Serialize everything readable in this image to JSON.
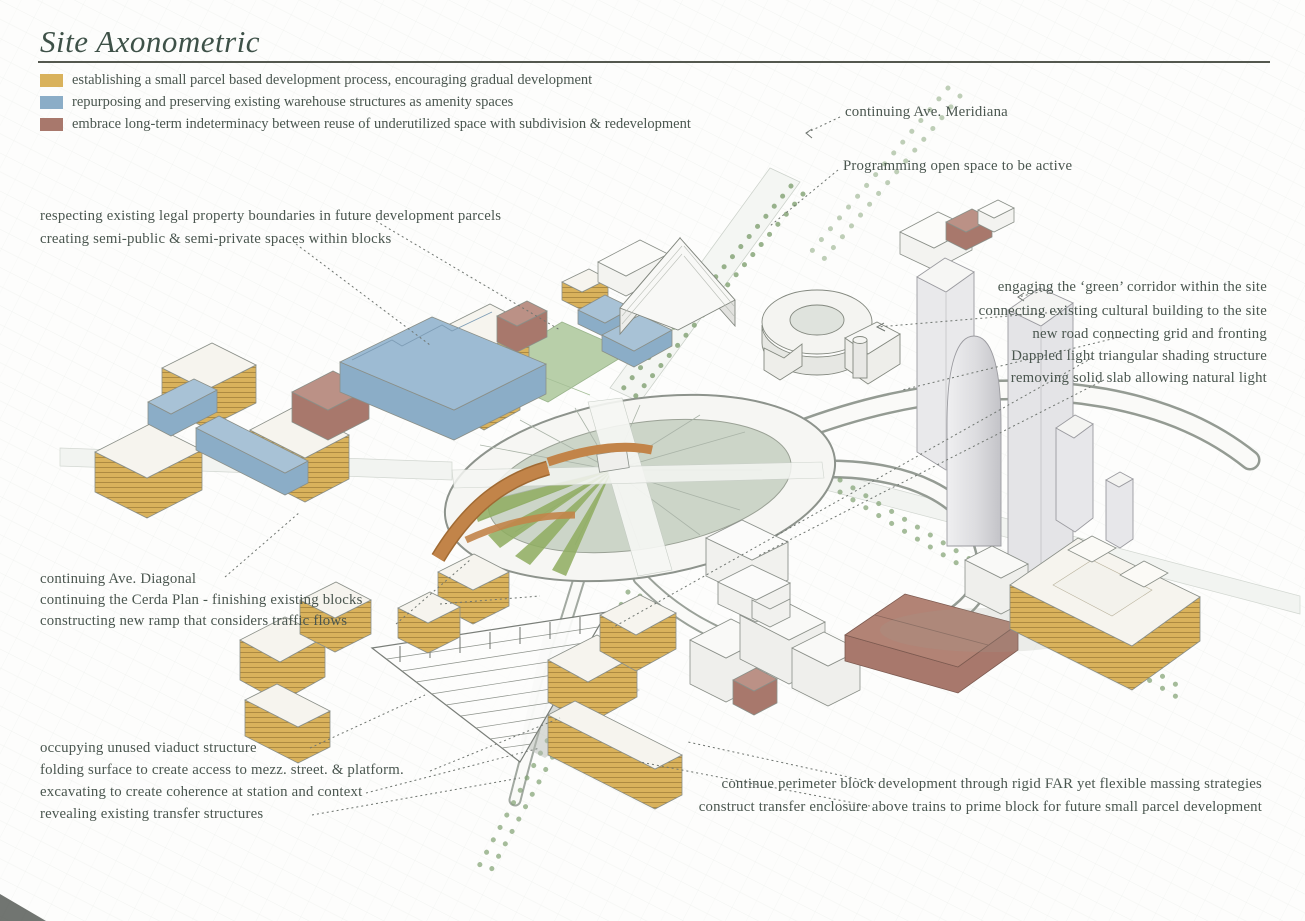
{
  "page": {
    "title": "Site Axonometric"
  },
  "legend": {
    "items": [
      {
        "label": "establishing a small parcel based development process, encouraging gradual development",
        "color": "#d9b25c"
      },
      {
        "label": "repurposing and preserving existing warehouse structures as amenity spaces",
        "color": "#8badc7"
      },
      {
        "label": "embrace long-term indeterminacy between reuse of underutilized space with subdivision & redevelopment",
        "color": "#a8786c"
      }
    ]
  },
  "annotations": {
    "meridiana": "continuing Ave. Meridiana",
    "open_space": "Programming open space to be active",
    "boundaries": "respecting existing legal property boundaries in future development parcels",
    "semi_public": "creating semi-public & semi-private spaces within blocks",
    "green_corridor": "engaging the ‘green’ corridor within the site",
    "cultural_building": "connecting existing cultural building to the site",
    "new_road": "new road connecting grid and fronting",
    "dappled_light": "Dappled light triangular shading structure",
    "solid_slab": "removing solid slab allowing natural light",
    "diagonal": "continuing Ave. Diagonal",
    "cerda_plan": "continuing the Cerda Plan - finishing existing blocks",
    "new_ramp": "constructing new ramp that considers traffic flows",
    "viaduct": "occupying unused viaduct structure",
    "folding_surface": "folding surface to create access to mezz. street. & platform.",
    "excavating": "excavating to create coherence at station and context",
    "revealing": "revealing existing transfer structures",
    "perimeter_block": "continue perimeter block development through rigid FAR yet flexible massing strategies",
    "transfer_enclosure": "construct transfer enclosure above trains to prime block for future small parcel development"
  },
  "colors": {
    "parcel_yellow": "#d9b25c",
    "warehouse_blue": "#8badc7",
    "reuse_brown": "#a8786c",
    "ramp_orange": "#c28449",
    "park_green": "#b8cfa9",
    "plaza_sage": "#ccd5c8",
    "wedge_green": "#8fad60",
    "ink": "#4a564f",
    "title_ink": "#3e5148",
    "line_gray": "#8d938c"
  }
}
